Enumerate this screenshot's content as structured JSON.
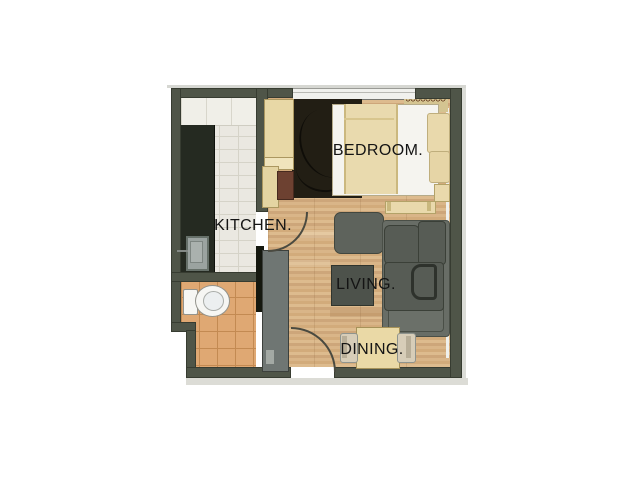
{
  "rooms": {
    "kitchen": {
      "label": "KITCHEN."
    },
    "bedroom": {
      "label": "BEDROOM."
    },
    "living": {
      "label": "LIVING."
    },
    "dining": {
      "label": "DINING."
    }
  },
  "palette": {
    "background": "#ffffff",
    "wall": "#4f5548",
    "wall_outline": "#373c31",
    "kitchen_tile": "#eae8e1",
    "bathroom_tile": "#dfa873",
    "wood_floor": "#d7b285",
    "counter": "#252a21",
    "bedroom_rug": "#221e14",
    "sofa_gray": "#575c55",
    "furniture_cream": "#e9d9ac",
    "coffee_table": "#4d524b",
    "label_text": "#141414"
  }
}
